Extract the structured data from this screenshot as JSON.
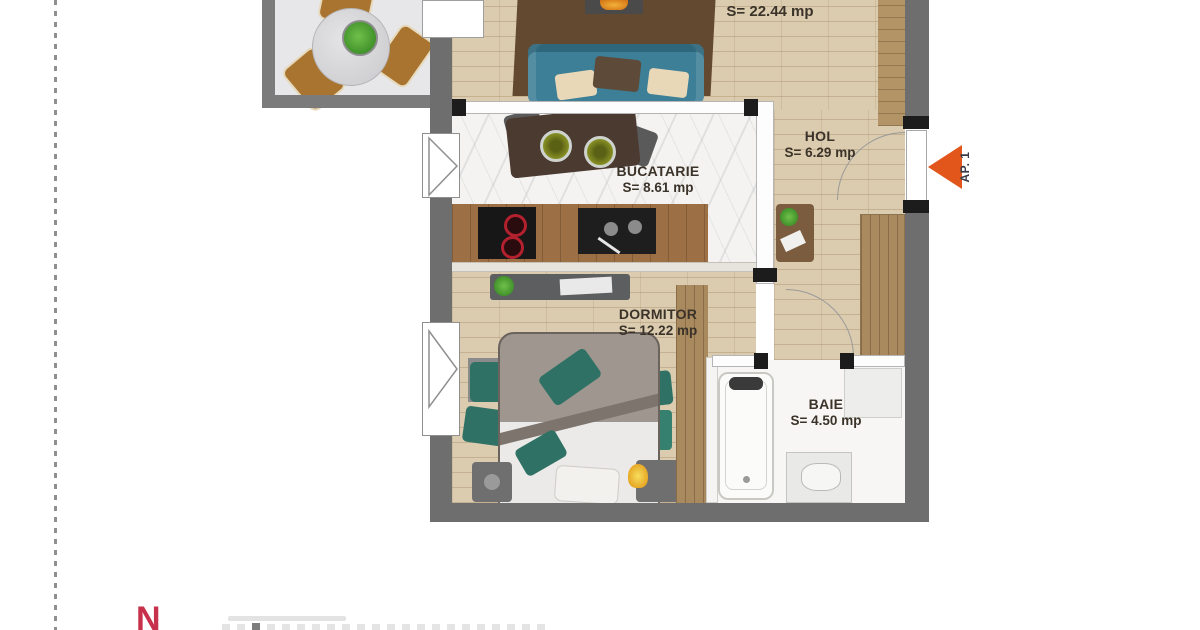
{
  "rooms": {
    "living": {
      "area": "S= 22.44 mp"
    },
    "bucatarie": {
      "name": "BUCATARIE",
      "area": "S= 8.61 mp"
    },
    "hol": {
      "name": "HOL",
      "area": "S= 6.29 mp"
    },
    "dormitor": {
      "name": "DORMITOR",
      "area": "S= 12.22 mp"
    },
    "baie": {
      "name": "BAIE",
      "area": "S= 4.50 mp"
    }
  },
  "entrance": {
    "label": "AP. 1"
  },
  "compass": {
    "north": "N"
  },
  "colors": {
    "wall": "#6e6e6e",
    "balcony_wall": "#7b7b7b",
    "balcony_floor": "#e7e7e9",
    "wood_floor": "#dbcbaf",
    "marble_floor": "#f4f3f1",
    "entrance_arrow": "#e2551b",
    "north_letter": "#c8314b",
    "sofa": "#3c7f97",
    "pillow_green": "#2f7265",
    "counter_wood": "#9c6f44",
    "rug_brown": "#63492f",
    "wardrobe_wood": "#a98a5e"
  }
}
